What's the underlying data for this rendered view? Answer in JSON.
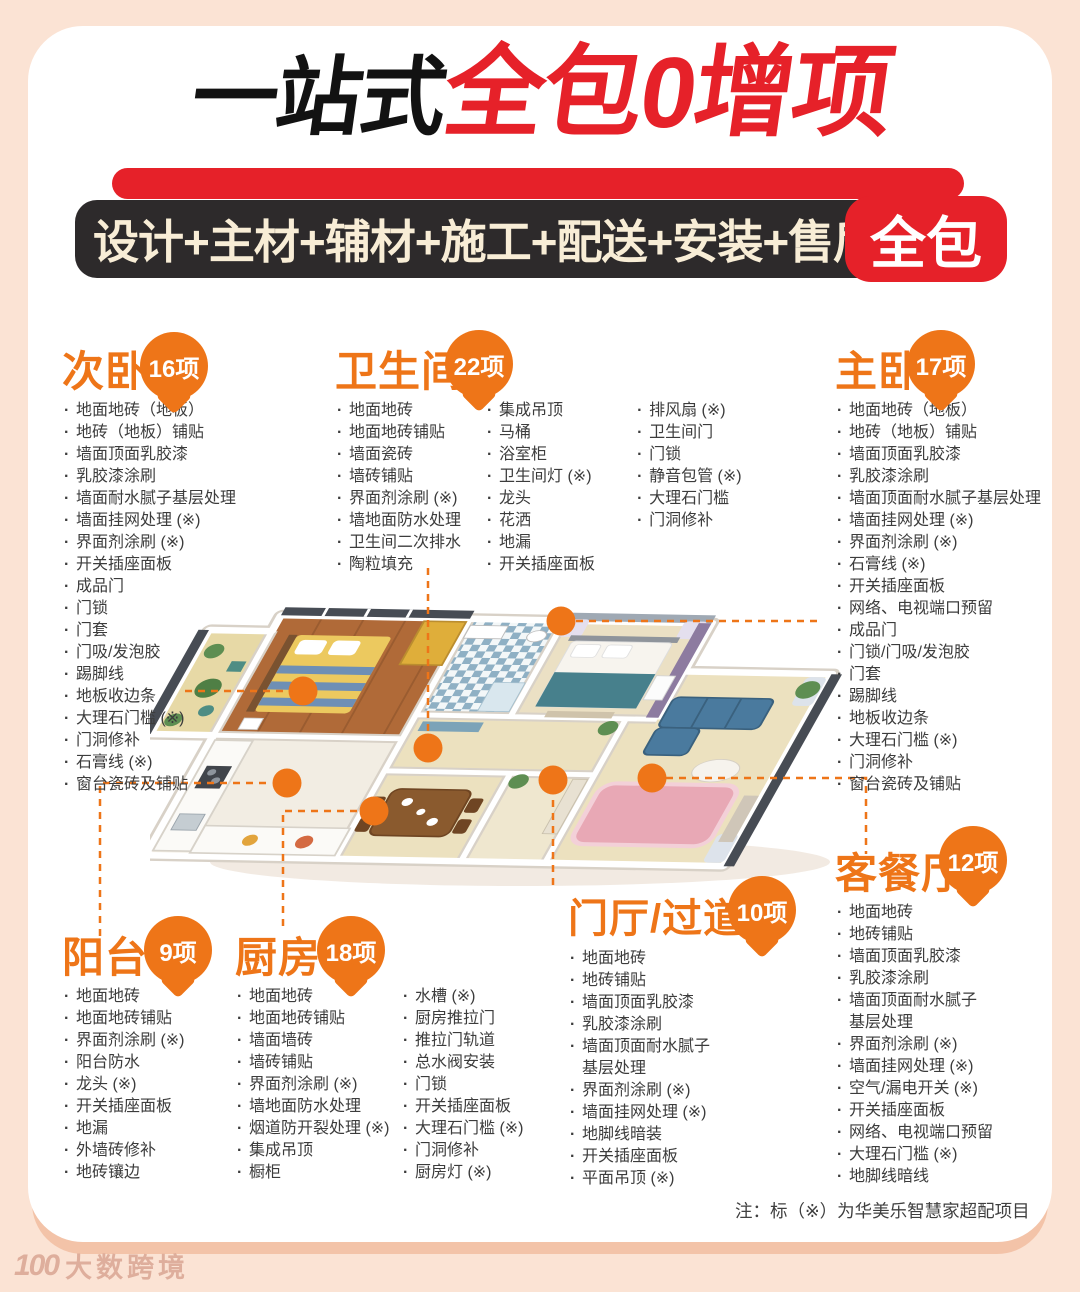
{
  "poster": {
    "title": {
      "prefix": "一站式",
      "highlight": "全包0增项"
    },
    "banner": {
      "text": "设计+主材+辅材+施工+配送+安装+售后",
      "badge": "全包"
    },
    "note": "注：标（※）为华美乐智慧家超配项目",
    "watermark": {
      "logo": "100",
      "text": "大数跨境"
    },
    "colors": {
      "accent_orange": "#ee7518",
      "brand_red": "#e62129",
      "banner_dark": "#2d2a2b",
      "page_bg": "#fbe3d4",
      "list_text": "#3c3c3c"
    }
  },
  "sections": [
    {
      "id": "ciwo",
      "name": "次卧",
      "badge": "16项",
      "columns": [
        [
          "地面地砖（地板）",
          "地砖（地板）铺贴",
          "墙面顶面乳胶漆",
          "乳胶漆涂刷",
          "墙面耐水腻子基层处理",
          "墙面挂网处理 (※)",
          "界面剂涂刷 (※)",
          "开关插座面板",
          "成品门",
          "门锁",
          "门套",
          "门吸/发泡胶",
          "踢脚线",
          "地板收边条",
          "大理石门槛 (※)",
          "门洞修补",
          "石膏线 (※)",
          "窗台瓷砖及铺贴"
        ]
      ]
    },
    {
      "id": "wsj",
      "name": "卫生间",
      "badge": "22项",
      "columns": [
        [
          "地面地砖",
          "地面地砖铺贴",
          "墙面瓷砖",
          "墙砖铺贴",
          "界面剂涂刷 (※)",
          "墙地面防水处理",
          "卫生间二次排水",
          "陶粒填充"
        ],
        [
          "集成吊顶",
          "马桶",
          "浴室柜",
          "卫生间灯 (※)",
          "龙头",
          "花洒",
          "地漏",
          "开关插座面板"
        ],
        [
          "排风扇 (※)",
          "卫生间门",
          "门锁",
          "静音包管 (※)",
          "大理石门槛",
          "门洞修补"
        ]
      ]
    },
    {
      "id": "zhuwo",
      "name": "主卧",
      "badge": "17项",
      "columns": [
        [
          "地面地砖（地板）",
          "地砖（地板）铺贴",
          "墙面顶面乳胶漆",
          "乳胶漆涂刷",
          "墙面顶面耐水腻子基层处理",
          "墙面挂网处理 (※)",
          "界面剂涂刷 (※)",
          "石膏线 (※)",
          "开关插座面板",
          "网络、电视端口预留",
          "成品门",
          "门锁/门吸/发泡胶",
          "门套",
          "踢脚线",
          "地板收边条",
          "大理石门槛 (※)",
          "门洞修补",
          "窗台瓷砖及铺贴"
        ]
      ]
    },
    {
      "id": "yangtai",
      "name": "阳台",
      "badge": "9项",
      "columns": [
        [
          "地面地砖",
          "地面地砖铺贴",
          "界面剂涂刷 (※)",
          "阳台防水",
          "龙头 (※)",
          "开关插座面板",
          "地漏",
          "外墙砖修补",
          "地砖镶边"
        ]
      ]
    },
    {
      "id": "chufang",
      "name": "厨房",
      "badge": "18项",
      "columns": [
        [
          "地面地砖",
          "地面地砖铺贴",
          "墙面墙砖",
          "墙砖铺贴",
          "界面剂涂刷 (※)",
          "墙地面防水处理",
          "烟道防开裂处理 (※)",
          "集成吊顶",
          "橱柜"
        ],
        [
          "水槽 (※)",
          "厨房推拉门",
          "推拉门轨道",
          "总水阀安装",
          "门锁",
          "开关插座面板",
          "大理石门槛 (※)",
          "门洞修补",
          "厨房灯 (※)"
        ]
      ]
    },
    {
      "id": "menting",
      "name": "门厅/过道",
      "badge": "10项",
      "columns": [
        [
          "地面地砖",
          "地砖铺贴",
          "墙面顶面乳胶漆",
          "乳胶漆涂刷",
          "墙面顶面耐水腻子\n基层处理",
          "界面剂涂刷 (※)",
          "墙面挂网处理 (※)",
          "地脚线暗装",
          "开关插座面板",
          "平面吊顶 (※)"
        ]
      ]
    },
    {
      "id": "kecanting",
      "name": "客餐厅",
      "badge": "12项",
      "columns": [
        [
          "地面地砖",
          "地砖铺贴",
          "墙面顶面乳胶漆",
          "乳胶漆涂刷",
          "墙面顶面耐水腻子\n基层处理",
          "界面剂涂刷 (※)",
          "墙面挂网处理 (※)",
          "空气/漏电开关 (※)",
          "开关插座面板",
          "网络、电视端口预留",
          "大理石门槛 (※)",
          "地脚线暗线"
        ]
      ]
    }
  ]
}
